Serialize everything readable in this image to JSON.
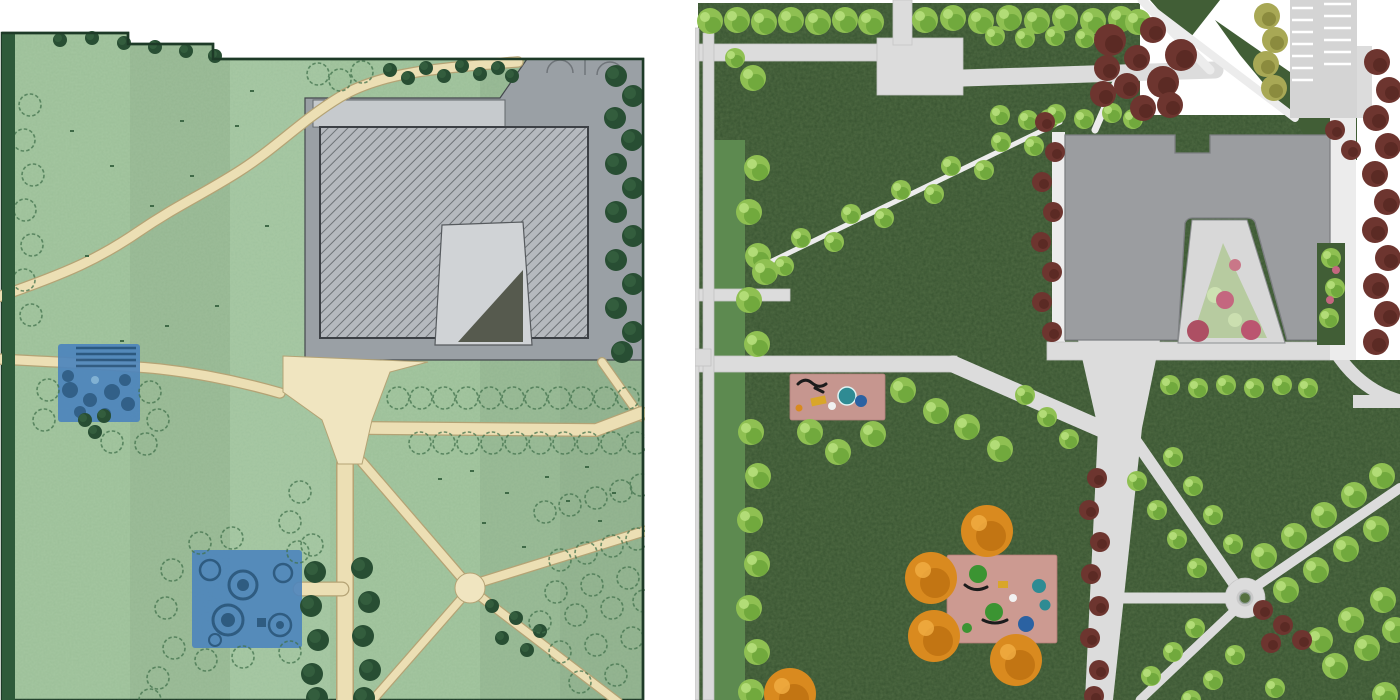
{
  "page": {
    "title": "Park master plan comparison",
    "background": "#ffffff"
  },
  "panels": {
    "left": {
      "id": "site-plan-sketch",
      "label": "Schematic park site plan, sketch style",
      "features": [
        "lawn",
        "winding-gravel-path",
        "central-plaza",
        "path-network",
        "hatched-building-pad",
        "parking-stalls",
        "tree-plantings",
        "upper-blue-activity-area",
        "lower-blue-activity-area",
        "perimeter-hedge"
      ]
    },
    "right": {
      "id": "site-plan-rendered",
      "label": "Rendered park master plan",
      "features": [
        "dark-lawn",
        "street-sidewalk",
        "entry-plaza",
        "community-building",
        "courtyard-planting",
        "parking-lot",
        "small-playground",
        "large-playground",
        "roundabout-node",
        "tree-allees",
        "fall-color-trees"
      ]
    }
  },
  "colors": {
    "plan_green": "#a5c7a1",
    "plan_outline": "#1d3a27",
    "hedge": "#2e5a3a",
    "tree_outline": "#41724c",
    "dark_tree": "#284e33",
    "dark_tree_light": "#3d6b47",
    "path_tan": "#ecdfb4",
    "path_tan_edge": "#b4a375",
    "plaza_tan": "#f0e5c0",
    "gray_zone": "#9aa0a5",
    "building_fill": "#b5b9be",
    "hatch_line": "#6e7377",
    "building_edge": "#3c4045",
    "apron": "#c6cacd",
    "courtyard_left": "#d0d3d6",
    "triangle_dark": "#565a4e",
    "water_blue": "#4d85bd",
    "water_blue_dark": "#23517e",
    "tuft": "#3f6a47",
    "lawn": "#3a5632",
    "bed_dark": "#415e36",
    "strip_green": "#5d8a50",
    "path_gray": "#dcdcdc",
    "path_edge": "#c6c6c6",
    "parking": "#d4d4d4",
    "stripe_white": "#ffffff",
    "building_gray": "#9b9da0",
    "building_edge2": "#7d7f82",
    "courtyard2": "#d8d8d8",
    "court_planting": "#b7cba0",
    "tree_light": "#8fc052",
    "tree_light_dark": "#67a137",
    "tree_light_hi": "#b9e07e",
    "olive": "#a8a855",
    "olive_dark": "#7f7f35",
    "maroon": "#6d352f",
    "maroon_dark": "#54261f",
    "orange": "#d98a1f",
    "orange_dark": "#b66a0e",
    "orange_light": "#f0ab42",
    "pink_play": "#c6968f",
    "pink_play2": "#cc9a91",
    "round_green": "#55703f",
    "eq_teal": "#2f8b93",
    "eq_blue": "#2b62a2",
    "eq_green": "#3b9432",
    "eq_yellow": "#d9a62a",
    "eq_dark": "#1c1c1c"
  }
}
